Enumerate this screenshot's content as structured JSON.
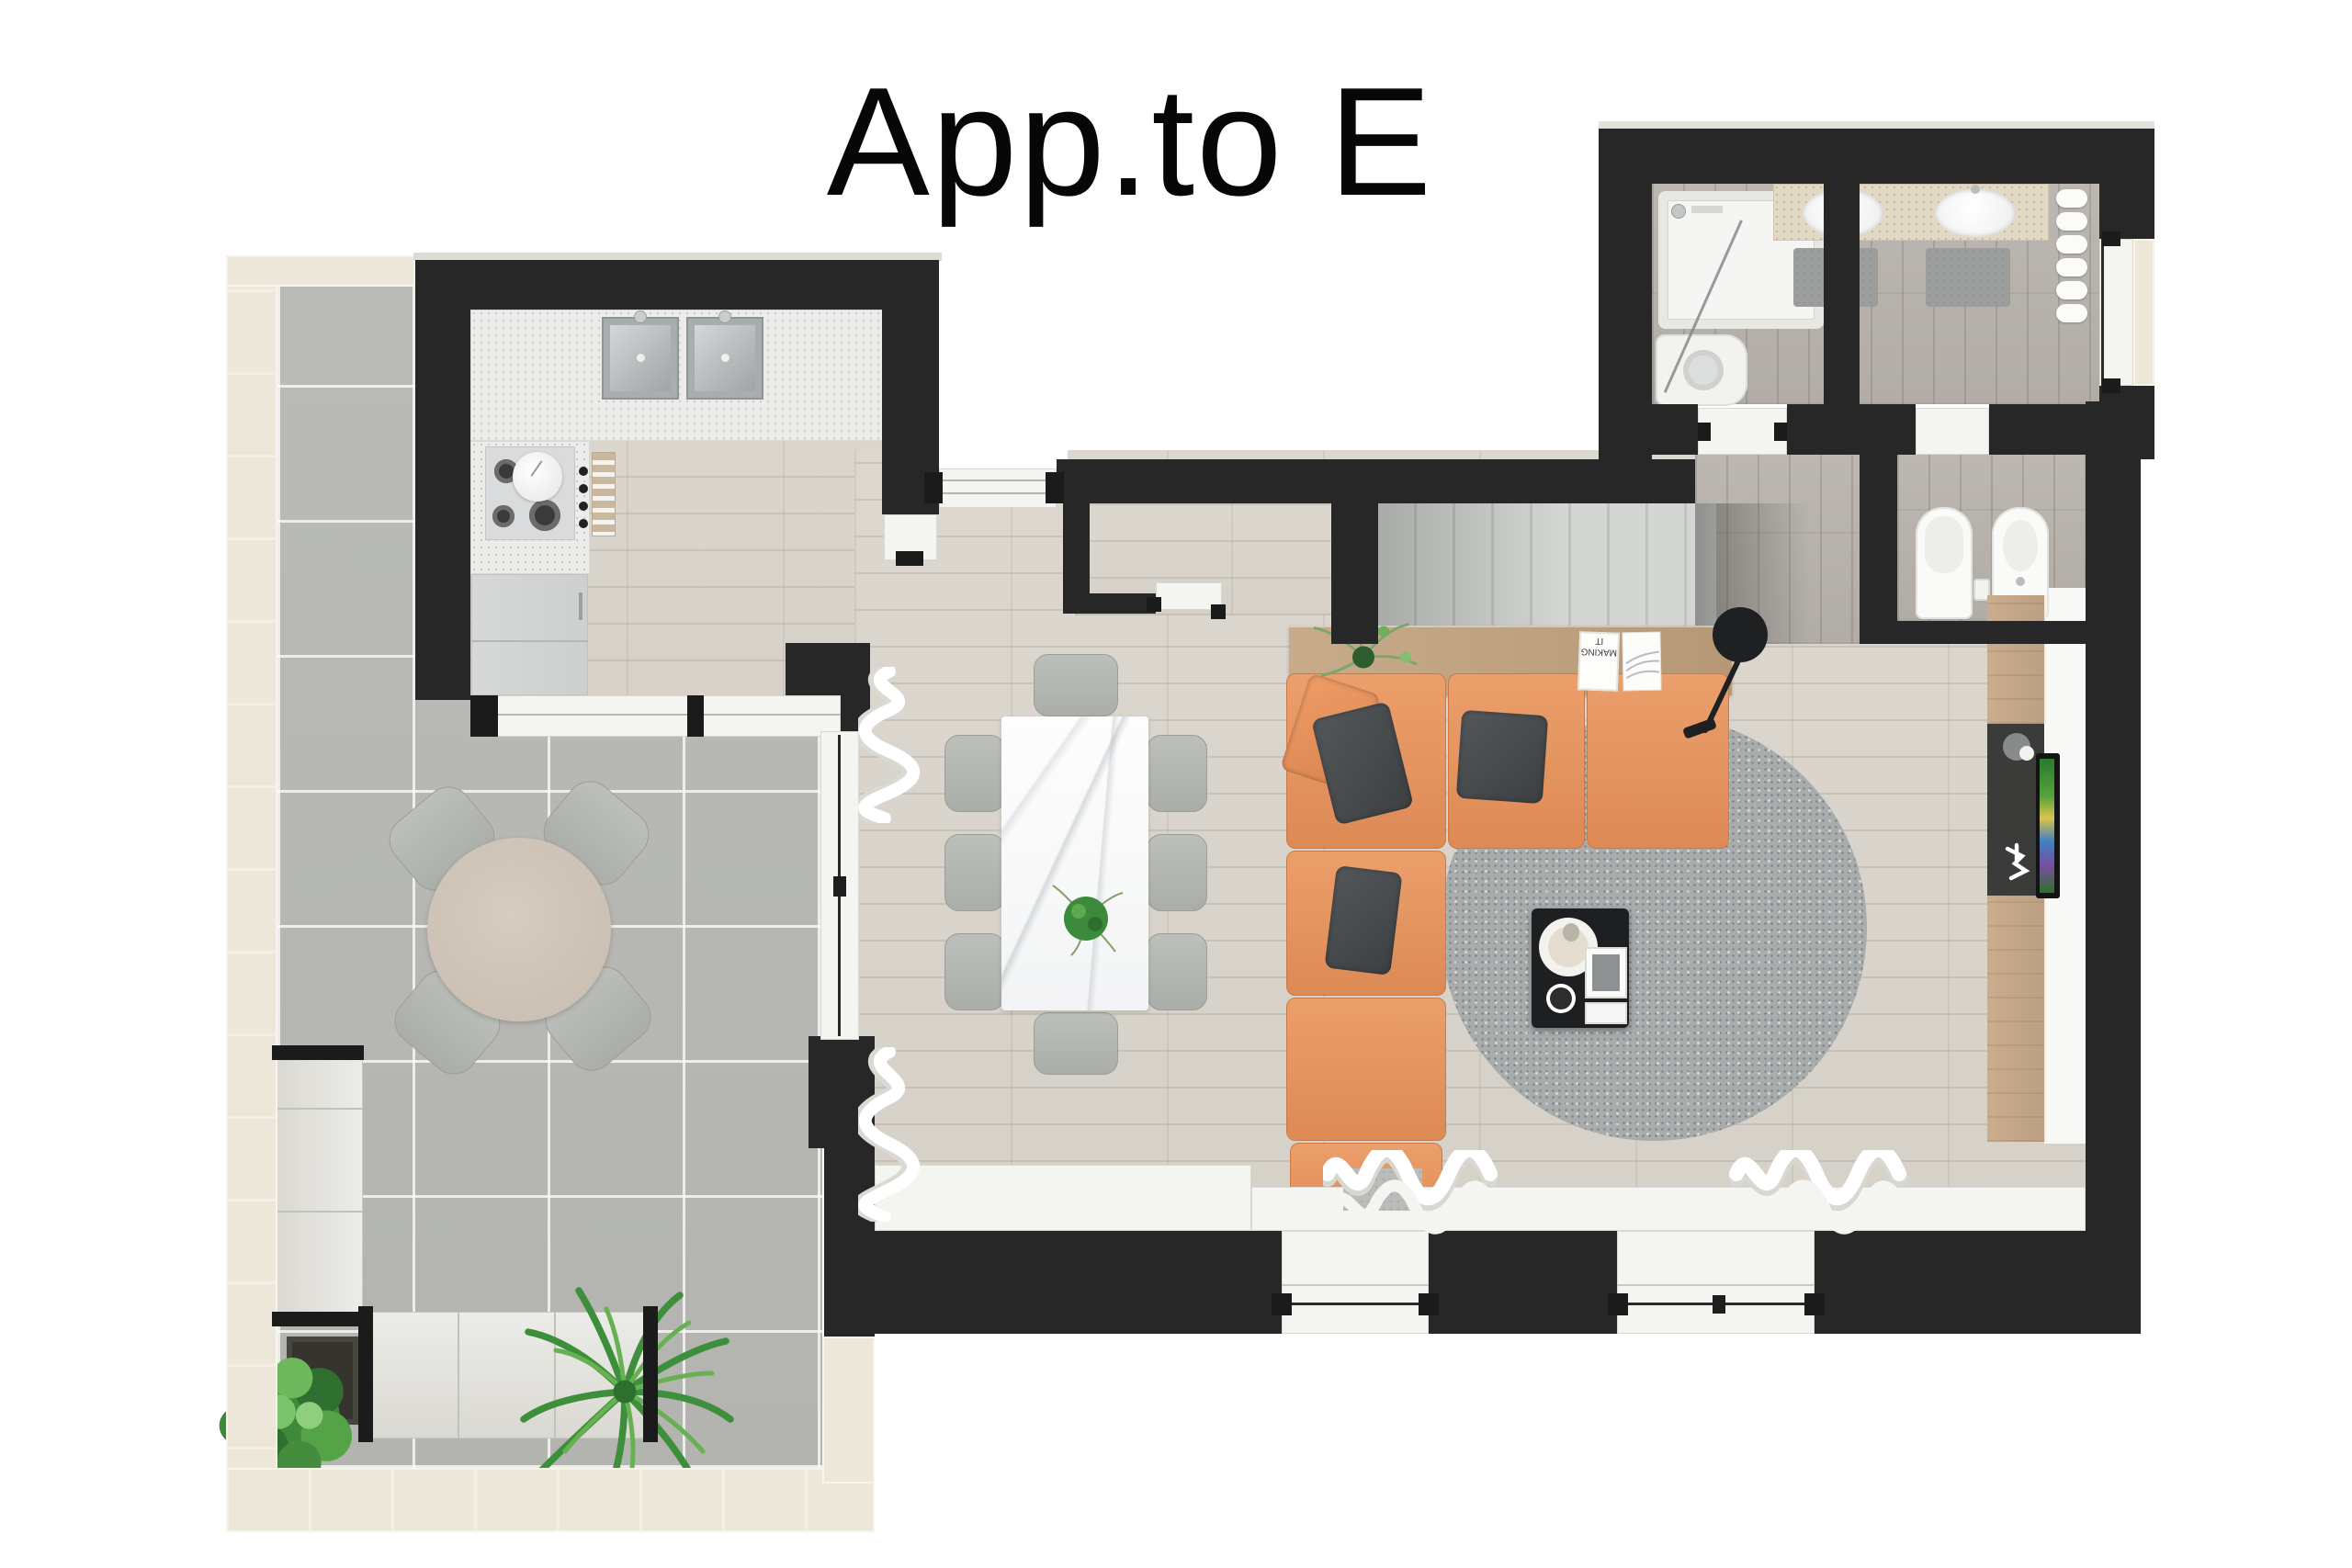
{
  "title": "App.to E",
  "console_decor": {
    "book_title": "MAKING IT"
  },
  "palette": {
    "wall_dark": "#272727",
    "exterior_wall_cream": "#ece7d9",
    "terrace_tile_gray": "#b7b8b4",
    "wood_floor": "#d9d5cd",
    "bathroom_floor": "#bbb6b0",
    "kitchen_counter": "#ececea",
    "stairs_gray": "#ced1ce",
    "sofa_orange": "#e2905e",
    "cushion_charcoal": "#46494b",
    "rug_gray": "#a8acad",
    "console_wood": "#c0a483",
    "coffee_table_black": "#1d1f20",
    "marble_white": "#f7f8f8",
    "outdoor_table_beige": "#cec4b7",
    "chair_gray": "#b4b7b2",
    "fixture_white": "#fafafa",
    "plant_green": "#4e9b4a",
    "tv_panel_dark": "#3b3b39"
  },
  "areas": {
    "terrace": [
      "round-outdoor-table",
      "outdoor-chair",
      "outdoor-sofa-l-shape",
      "outdoor-side-table",
      "bush-plant",
      "palm-plant"
    ],
    "kitchen": [
      "double-sink",
      "faucet",
      "gas-hob",
      "kettle",
      "control-knobs",
      "slatted-cabinet",
      "fridge",
      "glass-partition-sill"
    ],
    "living_dining": [
      "marble-dining-table",
      "dining-chair",
      "potted-plant",
      "orange-sectional-sofa",
      "throw-pillow",
      "round-rug",
      "coffee-table",
      "tray",
      "books",
      "console-table",
      "floor-lamp",
      "curtains",
      "windows"
    ],
    "tv_wall": [
      "wood-sideboard",
      "media-panel",
      "television",
      "decor-disc",
      "figurine"
    ],
    "stair_hall": [
      "staircase",
      "entry-door",
      "hallway-window"
    ],
    "bathroom": [
      "bathtub",
      "shower-glass",
      "washing-machine",
      "double-vanity",
      "oval-sink",
      "bath-mat",
      "towel-radiator",
      "toilet",
      "bidet",
      "bathroom-window",
      "door-thresholds"
    ]
  }
}
